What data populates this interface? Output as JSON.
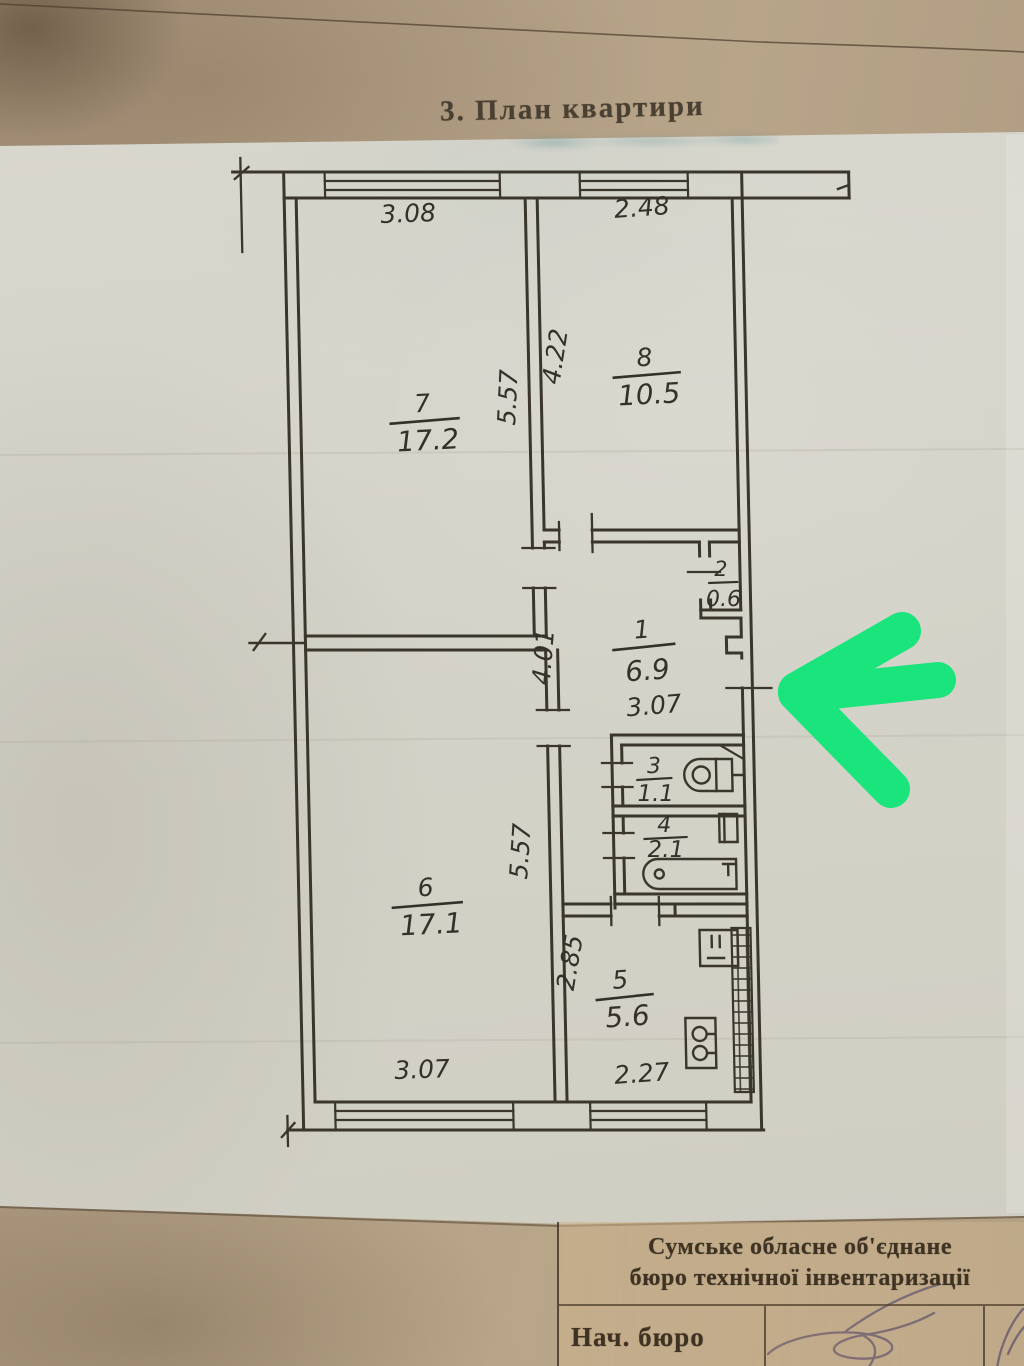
{
  "title": "3. План квартири",
  "plan": {
    "ink_color": "#3a362c",
    "rooms": [
      {
        "number": "7",
        "area": "17.2"
      },
      {
        "number": "8",
        "area": "10.5"
      },
      {
        "number": "1",
        "area": "6.9"
      },
      {
        "number": "2",
        "area": "0.6"
      },
      {
        "number": "3",
        "area": "1.1"
      },
      {
        "number": "4",
        "area": "2.1"
      },
      {
        "number": "6",
        "area": "17.1"
      },
      {
        "number": "5",
        "area": "5.6"
      }
    ],
    "dimensions": {
      "top_left_window": "3.08",
      "top_right_window": "2.48",
      "room7_depth": "5.57",
      "room8_depth": "4.22",
      "hall_depth": "4.01",
      "hall_width": "3.07",
      "room6_depth": "5.57",
      "kitchen_depth": "2.85",
      "bottom_left_window": "3.07",
      "bottom_right_window": "2.27"
    }
  },
  "annotation": {
    "arrow_color": "#1ae47c",
    "arrow_direction": "left",
    "points_at": "entrance-door"
  },
  "footer": {
    "org_line1": "Сумське обласне об'єднане",
    "org_line2": "бюро технічної інвентаризації",
    "signatory_label": "Нач. бюро"
  }
}
